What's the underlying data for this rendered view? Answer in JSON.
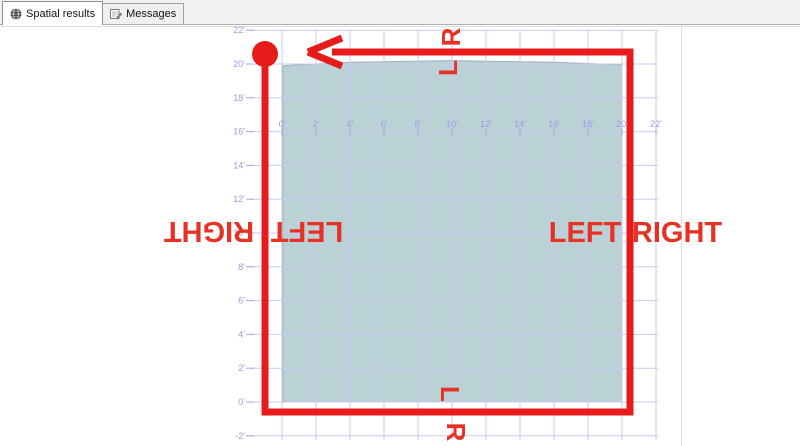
{
  "tab_bar": {
    "tabs": [
      {
        "label": "Spatial results",
        "icon": "globe-icon",
        "active": true
      },
      {
        "label": "Messages",
        "icon": "messages-icon",
        "active": false
      }
    ]
  },
  "colors": {
    "grid_line": "#c9c9f0",
    "tick_mark": "#a6a6e6",
    "axis_label": "#9a9ce0",
    "region_fill": "#bad1d6",
    "region_stroke": "#9fb3b8",
    "route_red": "#e81b1b",
    "label_red": "#e73125"
  },
  "chart_data": {
    "type": "spatial-plot",
    "unit": "feet",
    "tick_label_suffix": "'",
    "x_axis": {
      "tick_values": [
        0,
        2,
        4,
        6,
        8,
        10,
        12,
        14,
        16,
        18,
        20,
        22
      ]
    },
    "y_axis": {
      "tick_values": [
        22,
        20,
        18,
        16,
        14,
        12,
        10,
        8,
        6,
        4,
        2,
        0,
        -2
      ]
    },
    "scale": {
      "x0_px": 282,
      "px_per_ft_x": 17,
      "y0_px": 402,
      "px_per_ft_y": 16.9,
      "grid_left_px": 250,
      "grid_right_px": 658,
      "grid_top_px": 30,
      "grid_bottom_px": 440,
      "x_label_baseline_px": 127,
      "x_tick_line_ft": 16
    },
    "region_polygon_ft": [
      [
        0.05,
        19.9
      ],
      [
        4,
        20.1
      ],
      [
        10,
        20.2
      ],
      [
        16,
        20.1
      ],
      [
        20,
        19.95
      ],
      [
        20,
        0
      ],
      [
        0.05,
        0
      ]
    ],
    "route": {
      "description": "counterclockwise loop, start circle top-left, arrow pointing left",
      "line_width_px": 7,
      "start_circle_px": {
        "cx": 265,
        "cy": 54,
        "r": 13
      },
      "polyline_px": [
        [
          265,
          60
        ],
        [
          265,
          412
        ],
        [
          630,
          412
        ],
        [
          630,
          52
        ],
        [
          332,
          52
        ]
      ],
      "arrow_px": {
        "tip": [
          308,
          52
        ],
        "wing_top": [
          342,
          38
        ],
        "wing_bottom": [
          342,
          66
        ]
      }
    },
    "annotations": [
      {
        "text": "R",
        "x": 451,
        "y": 37,
        "rot": -90,
        "size": 26
      },
      {
        "text": "L",
        "x": 448,
        "y": 68,
        "rot": -90,
        "size": 26
      },
      {
        "text": "L",
        "x": 450,
        "y": 394,
        "rot": 90,
        "size": 26
      },
      {
        "text": "R",
        "x": 456,
        "y": 432,
        "rot": 90,
        "size": 26
      },
      {
        "text": "RIGHT",
        "x": 209,
        "y": 232,
        "rot": 180,
        "size": 29
      },
      {
        "text": "LEFT",
        "x": 307,
        "y": 232,
        "rot": 180,
        "size": 29
      },
      {
        "text": "LEFT",
        "x": 585,
        "y": 232,
        "rot": 0,
        "size": 29
      },
      {
        "text": "RIGHT",
        "x": 677,
        "y": 232,
        "rot": 0,
        "size": 29
      }
    ]
  }
}
